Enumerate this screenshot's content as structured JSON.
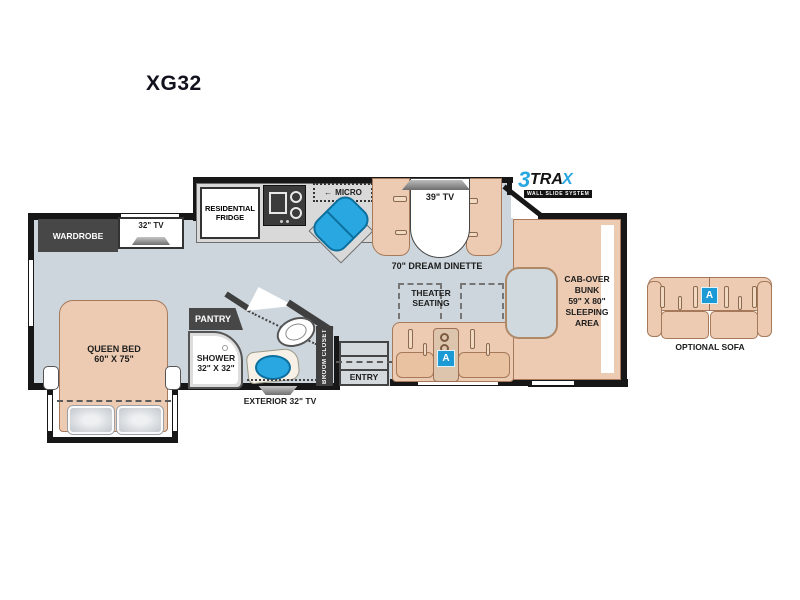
{
  "title": "XG32",
  "logo": {
    "three": "3",
    "tra": "TRA",
    "x": "X",
    "tagline": "WALL SLIDE SYSTEM"
  },
  "bedroom": {
    "wardrobe": "WARDROBE",
    "tv": "32\" TV",
    "bed_name": "QUEEN BED",
    "bed_size": "60\" X 75\""
  },
  "kitchen": {
    "fridge1": "RESIDENTIAL",
    "fridge2": "FRIDGE",
    "micro_arrow": "←",
    "micro": "MICRO"
  },
  "dinette": {
    "tv": "39\" TV",
    "label": "70\" DREAM DINETTE"
  },
  "bathroom": {
    "pantry": "PANTRY",
    "shower1": "SHOWER",
    "shower2": "32\" X 32\"",
    "broom": "BROOM CLOSET",
    "exterior_tv": "EXTERIOR 32\" TV"
  },
  "entry": {
    "label": "ENTRY"
  },
  "theater": {
    "line1": "THEATER",
    "line2": "SEATING",
    "badge": "A"
  },
  "cabover": {
    "line1": "CAB-OVER",
    "line2": "BUNK",
    "line3": "59\" X 80\"",
    "line4": "SLEEPING",
    "line5": "AREA"
  },
  "optional_sofa": {
    "label": "OPTIONAL SOFA",
    "badge": "A"
  },
  "colors": {
    "floor": "#cdd6dc",
    "furniture": "#edcbb2",
    "wall": "#171717",
    "dark_cabinet": "#474747",
    "accent_blue": "#29a7e0",
    "counter": "#d9d9d9"
  }
}
